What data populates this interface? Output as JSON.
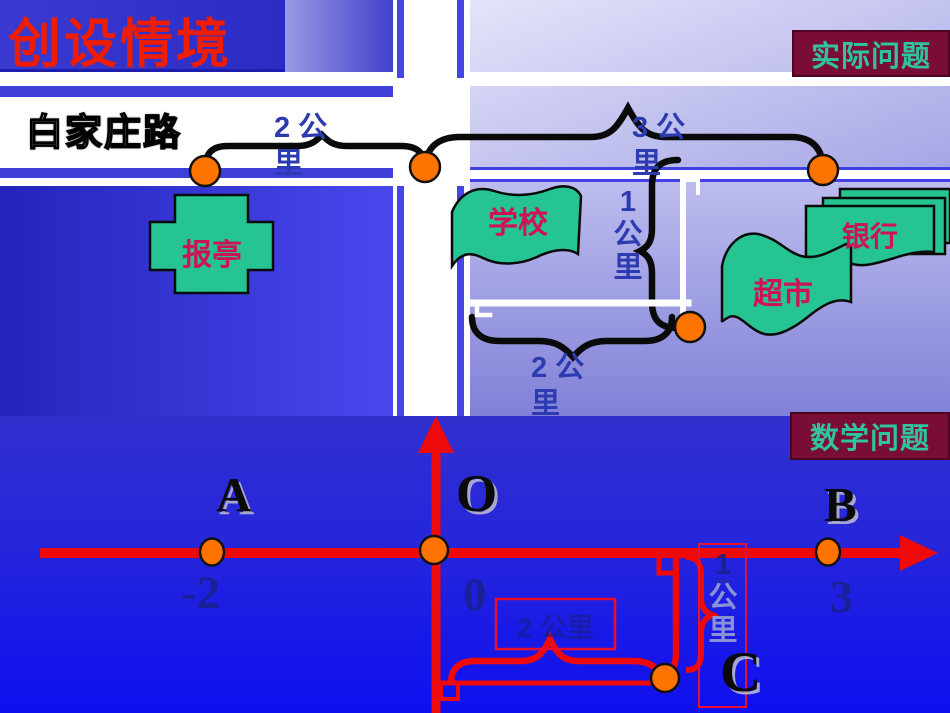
{
  "slide": {
    "title": "创设情境",
    "badge_real": "实际问题",
    "badge_math": "数学问题",
    "road_name": "白家庄路"
  },
  "map": {
    "dist_left": [
      "2 公",
      "里"
    ],
    "dist_right": [
      "3 公",
      "里"
    ],
    "dist_vertical": [
      "1",
      "公",
      "里"
    ],
    "dist_bottom": [
      "2 公",
      "里"
    ],
    "place_newsstand": "报亭",
    "place_school": "学校",
    "place_supermarket": "超市",
    "place_bank": "银行"
  },
  "numberline": {
    "point_a": "A",
    "point_o": "O",
    "point_b": "B",
    "point_c": "C",
    "tick_a": "-2",
    "tick_o": "0",
    "tick_b": "3",
    "hidden_horizontal": "2 公里",
    "hidden_vertical": [
      "1",
      "公",
      "里"
    ]
  },
  "colors": {
    "title_red": "#ee1c00",
    "badge_bg": "#7a0d36",
    "badge_text": "#2fc49e",
    "shape_green": "#27c493",
    "place_text": "#ce1158",
    "label_navy": "#2d3bb0",
    "dot_orange": "#ff7300",
    "axis_red": "#ee0a0a",
    "road_white": "#ffffff"
  }
}
